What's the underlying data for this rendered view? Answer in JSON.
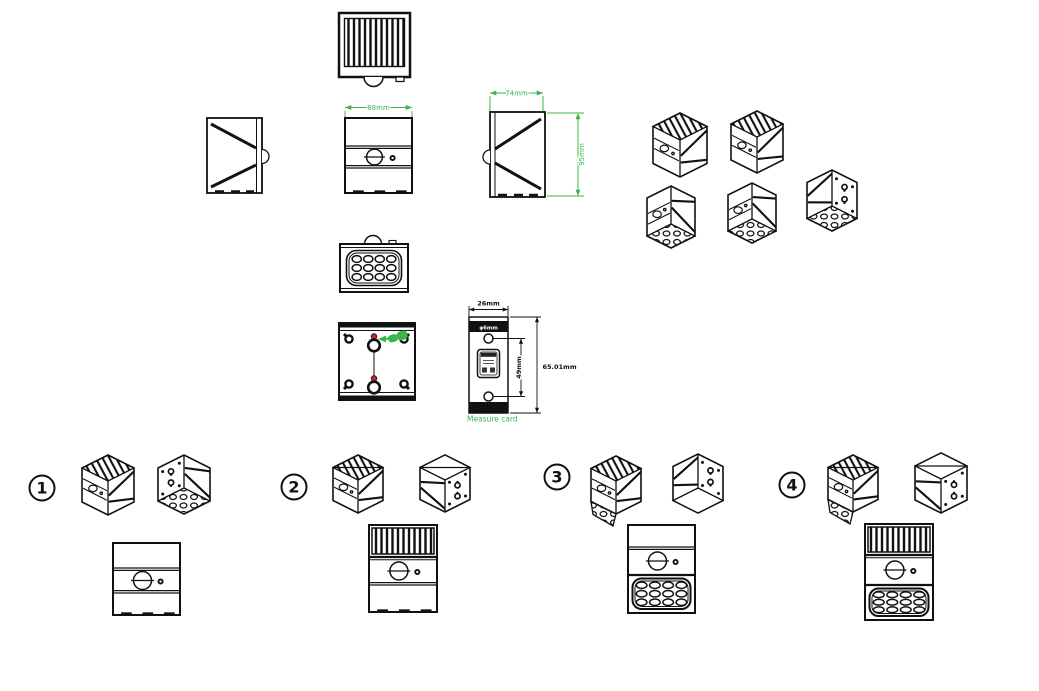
{
  "colors": {
    "line": "#111111",
    "dimension_green": "#3CB54A",
    "accent_red": "#C1272D",
    "background": "#FFFFFF"
  },
  "dimensions": {
    "front_width": "88mm",
    "depth": "74mm",
    "height": "95mm"
  },
  "measure_card": {
    "width": "26mm",
    "hole_spacing": "49mm",
    "total_height": "65.01mm",
    "hole_diameter": "φ6mm",
    "caption": "Measure card"
  },
  "variants": [
    {
      "label": "1"
    },
    {
      "label": "2"
    },
    {
      "label": "3"
    },
    {
      "label": "4"
    }
  ]
}
